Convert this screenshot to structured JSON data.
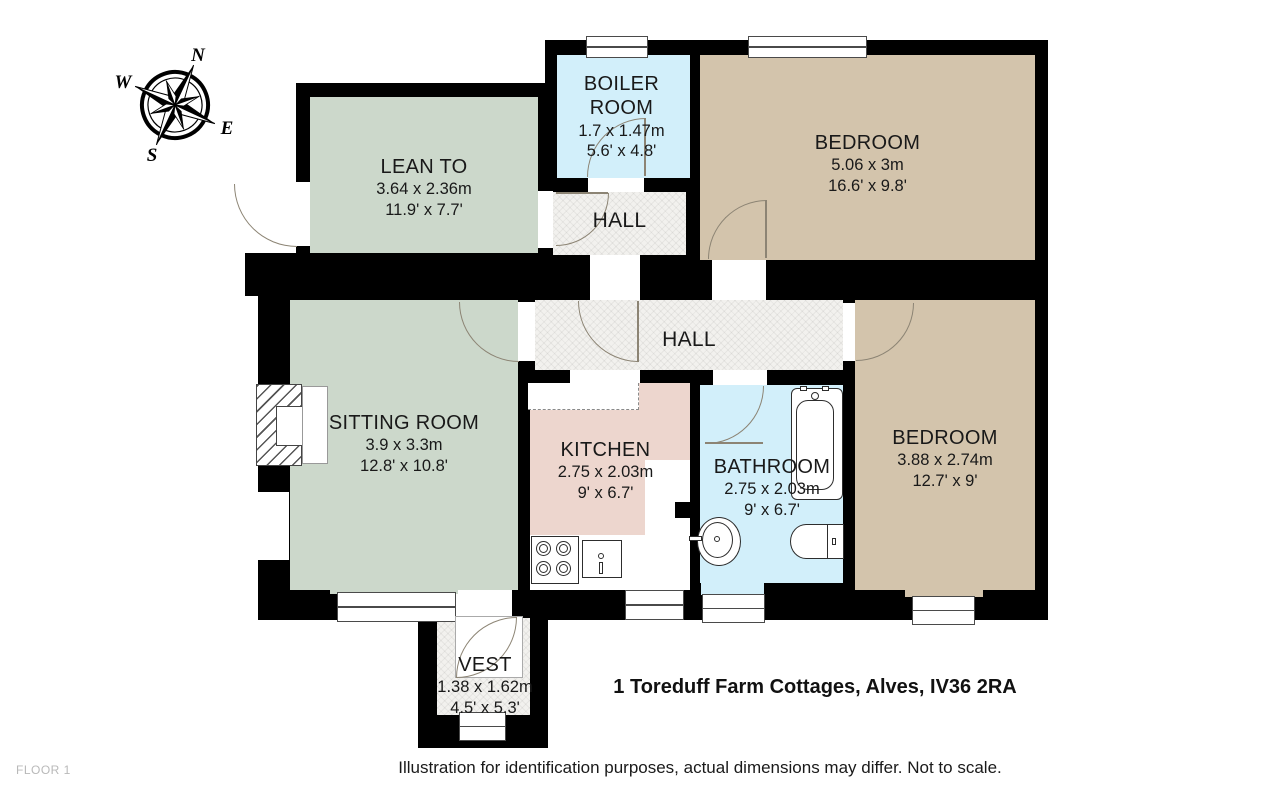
{
  "meta": {
    "address": "1 Toreduff Farm Cottages, Alves, IV36 2RA",
    "disclaimer": "Illustration for identification purposes, actual dimensions may differ. Not to scale.",
    "floor_label": "FLOOR 1"
  },
  "compass": {
    "north": "N",
    "east": "E",
    "south": "S",
    "west": "W"
  },
  "colors": {
    "wall": "#000000",
    "bedroom": "#d3c4ac",
    "living": "#ccd8cb",
    "wet_room": "#d2effa",
    "kitchen": "#edd6ce",
    "hall": "#f2f1ee"
  },
  "rooms": {
    "lean_to": {
      "name": "LEAN TO",
      "metric": "3.64 x 2.36m",
      "imperial": "11.9' x 7.7'"
    },
    "boiler_room": {
      "name": "BOILER ROOM",
      "metric": "1.7 x 1.47m",
      "imperial": "5.6' x 4.8'"
    },
    "bedroom_top": {
      "name": "BEDROOM",
      "metric": "5.06 x 3m",
      "imperial": "16.6' x 9.8'"
    },
    "hall_upper": {
      "name": "HALL"
    },
    "hall_main": {
      "name": "HALL"
    },
    "sitting_room": {
      "name": "SITTING ROOM",
      "metric": "3.9 x 3.3m",
      "imperial": "12.8' x 10.8'"
    },
    "kitchen": {
      "name": "KITCHEN",
      "metric": "2.75 x 2.03m",
      "imperial": "9' x 6.7'"
    },
    "bathroom": {
      "name": "BATHROOM",
      "metric": "2.75 x 2.03m",
      "imperial": "9' x 6.7'"
    },
    "bedroom_right": {
      "name": "BEDROOM",
      "metric": "3.88 x 2.74m",
      "imperial": "12.7' x 9'"
    },
    "vest": {
      "name": "VEST",
      "metric": "1.38 x 1.62m",
      "imperial": "4.5' x 5.3'"
    }
  }
}
